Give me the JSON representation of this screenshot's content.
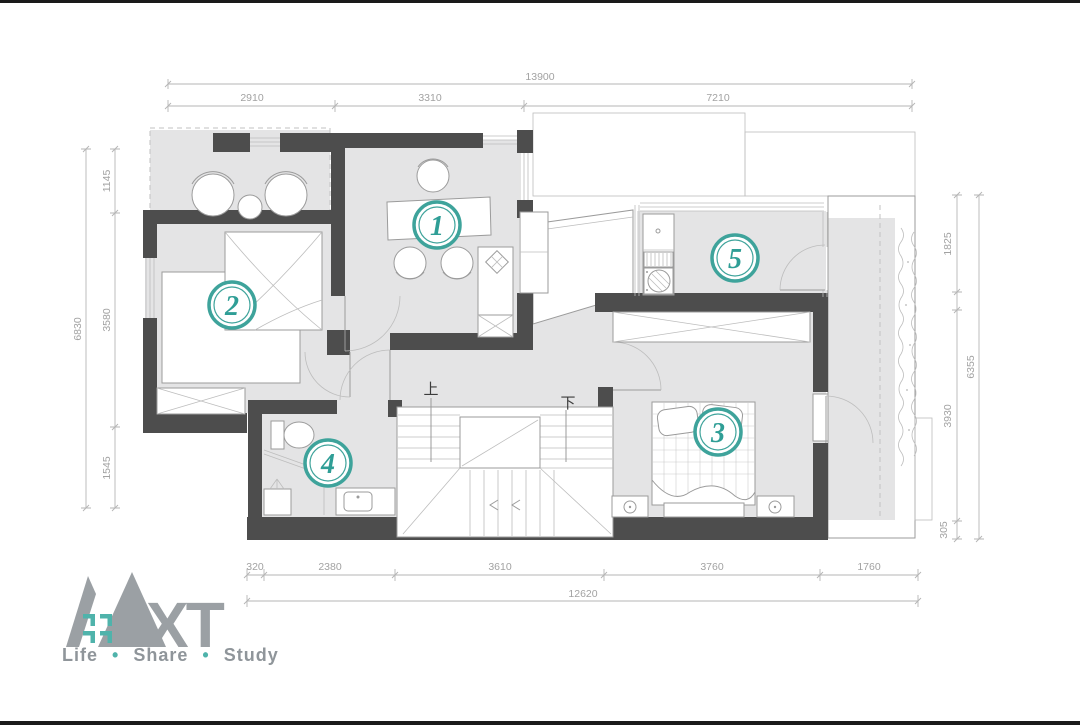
{
  "colors": {
    "accent_teal": "#3EA39B",
    "wall_dark": "#4D4D4D",
    "floor_gray": "#E4E4E5",
    "dim_line_gray": "#B5B5B5",
    "dim_text_gray": "#A2A2A2",
    "logo_gray": "#9BA0A4",
    "logo_teal": "#4FB3AB"
  },
  "dimensions": {
    "top": {
      "total": "13900",
      "segments": [
        "2910",
        "3310",
        "7210"
      ]
    },
    "left": {
      "total": "6830",
      "segments": [
        "1145",
        "3580",
        "1545"
      ]
    },
    "right": {
      "total": "6355",
      "segments": [
        "1825",
        "3930",
        "305"
      ]
    },
    "bottom": {
      "total": "12620",
      "segments": [
        "320",
        "2380",
        "3610",
        "3760",
        "1760"
      ]
    }
  },
  "room_labels": [
    {
      "number": "1"
    },
    {
      "number": "2"
    },
    {
      "number": "3"
    },
    {
      "number": "4"
    },
    {
      "number": "5"
    }
  ],
  "stair_labels": {
    "up": "上",
    "down": "下"
  },
  "logo": {
    "xt": "XT",
    "tagline": {
      "word1": "Life",
      "word2": "Share",
      "word3": "Study",
      "bullet": "•"
    }
  }
}
